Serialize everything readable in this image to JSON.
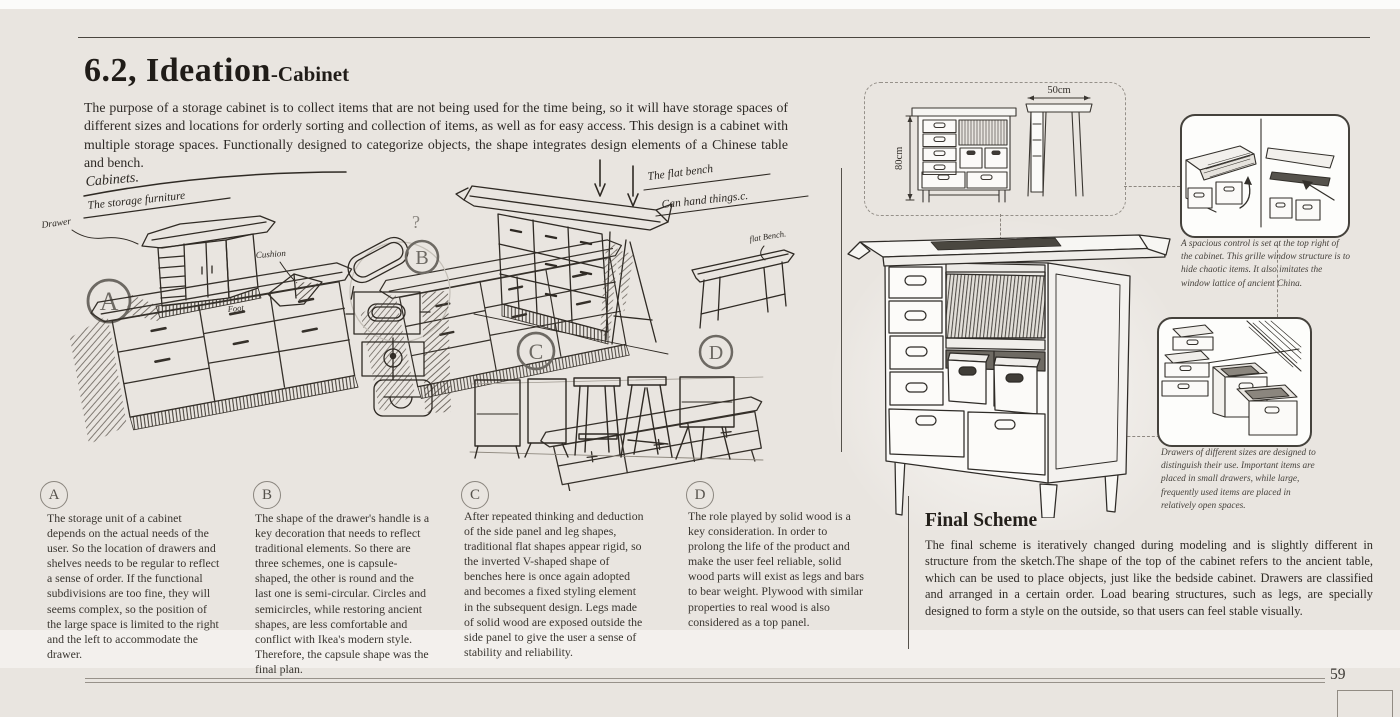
{
  "page": {
    "title_main": "6.2, Ideation",
    "title_sub": "-Cabinet",
    "intro": "The purpose of a storage cabinet is to collect items that are not being used for the time being, so it will have storage spaces of different sizes and locations for orderly sorting and collection of items, as well as for easy access. This design is a cabinet with multiple storage spaces. Functionally designed to categorize objects, the shape integrates design elements of a Chinese table and bench.",
    "page_number": "59"
  },
  "sketch": {
    "markers": [
      "A",
      "B",
      "C",
      "D"
    ],
    "handwritten": {
      "cabinets": "Cabinets.",
      "storage": "The storage furniture",
      "drawer": "Drawer",
      "cushion": "Cushion",
      "foot": "Foot",
      "question_mark": "?",
      "flat_bench_note_1": "The flat bench",
      "flat_bench_note_2": "Can hand things.c.",
      "flat_bench_label": "flat Bench."
    }
  },
  "tech_drawing": {
    "height_label": "80cm",
    "width_label": "50cm"
  },
  "callouts": [
    {
      "caption": "A spacious control is set at the top right of the cabinet. This grille window structure is to hide chaotic items. It also imitates the window lattice of ancient China."
    },
    {
      "caption": "Drawers of different sizes are designed to distinguish their use. Important items are placed in small drawers, while large, frequently used items are placed in relatively open spaces."
    }
  ],
  "annotations": [
    {
      "label": "A",
      "text": "The storage unit of a cabinet depends on the actual needs of the user. So the location of drawers and shelves needs to be regular to reflect a sense of order. If the functional subdivisions are too fine, they will seems complex, so the position of the large space is limited to the right and the left to accommodate the drawer."
    },
    {
      "label": "B",
      "text": "The shape of the drawer's handle is a key decoration that needs to reflect traditional elements. So there are three schemes, one is capsule-shaped, the other is round and the last one is semi-circular. Circles and semicircles, while restoring ancient shapes, are less comfortable and conflict with Ikea's modern style. Therefore, the capsule shape was the final plan."
    },
    {
      "label": "C",
      "text": "After repeated thinking and deduction of the side panel and leg shapes, traditional flat shapes appear rigid, so the inverted V-shaped shape of benches here is once again adopted and becomes a fixed styling element in the subsequent design. Legs made of solid wood are exposed outside the side panel to give the user a sense of stability and reliability."
    },
    {
      "label": "D",
      "text": "The role played by solid wood is a key consideration. In order to prolong the life of the product and make the user feel reliable, solid wood parts will exist as legs and bars to bear weight. Plywood with similar properties to real wood is also considered as a top panel."
    }
  ],
  "final_scheme": {
    "title": "Final Scheme",
    "text": "The final scheme is iteratively changed during modeling and is slightly different in structure from the sketch.The shape of the top of the cabinet refers to the ancient table, which can be used to place objects, just like the bedside cabinet. Drawers are classified and arranged in a certain order. Load bearing structures, such as legs, are specially designed to form a style on the outside, so that users can feel stable visually."
  },
  "colors": {
    "background": "#e9e5e0",
    "ink": "#2f2c28",
    "muted_gray": "#6d6963",
    "dashed_gray": "#8d8780"
  }
}
